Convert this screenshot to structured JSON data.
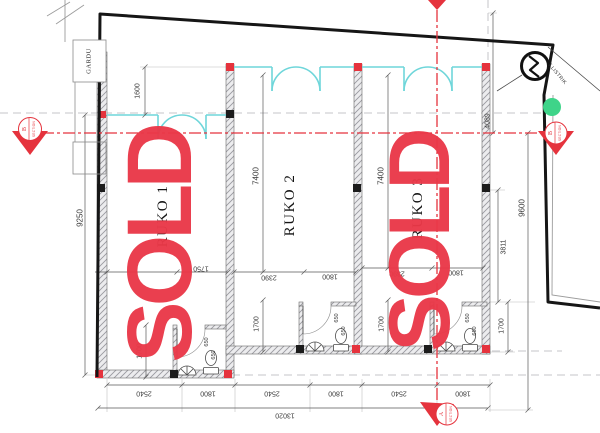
{
  "drawing": {
    "type": "architectural-site-plan",
    "labels": {
      "gardu": "GARDU",
      "electric_pole": "T.LISTRIK",
      "sold": "SOLD"
    },
    "units": [
      {
        "name": "RUKO 1",
        "status": "SOLD"
      },
      {
        "name": "RUKO 2",
        "status": ""
      },
      {
        "name": "RUKO 3",
        "status": "SOLD"
      }
    ],
    "markers": {
      "section_left": {
        "letter": "B",
        "word": "SECTION"
      },
      "section_right": {
        "letter": "B",
        "word": "SECTION"
      },
      "section_bottom": {
        "letter": "A",
        "word": "SECTION"
      }
    },
    "dims": {
      "site_left": "9250",
      "storefront_offset": "1600",
      "unit_depth": "7400",
      "r1_front": "1750",
      "shop_width": "2390",
      "bath_width": "1800",
      "bath_height": "1700",
      "fixture": "650",
      "right_top": "4089",
      "right_full": "9600",
      "right_lower": "3811",
      "bottom": [
        "2540",
        "1800",
        "2540",
        "1800",
        "2540",
        "1800"
      ],
      "total_width": "13020"
    },
    "colors": {
      "accent_red": "#e5333d",
      "sold_red": "#ea3848",
      "storefront_cyan": "#6fd6da",
      "dot_green": "#3ed489",
      "wall_gray": "#9a9aa0"
    }
  }
}
